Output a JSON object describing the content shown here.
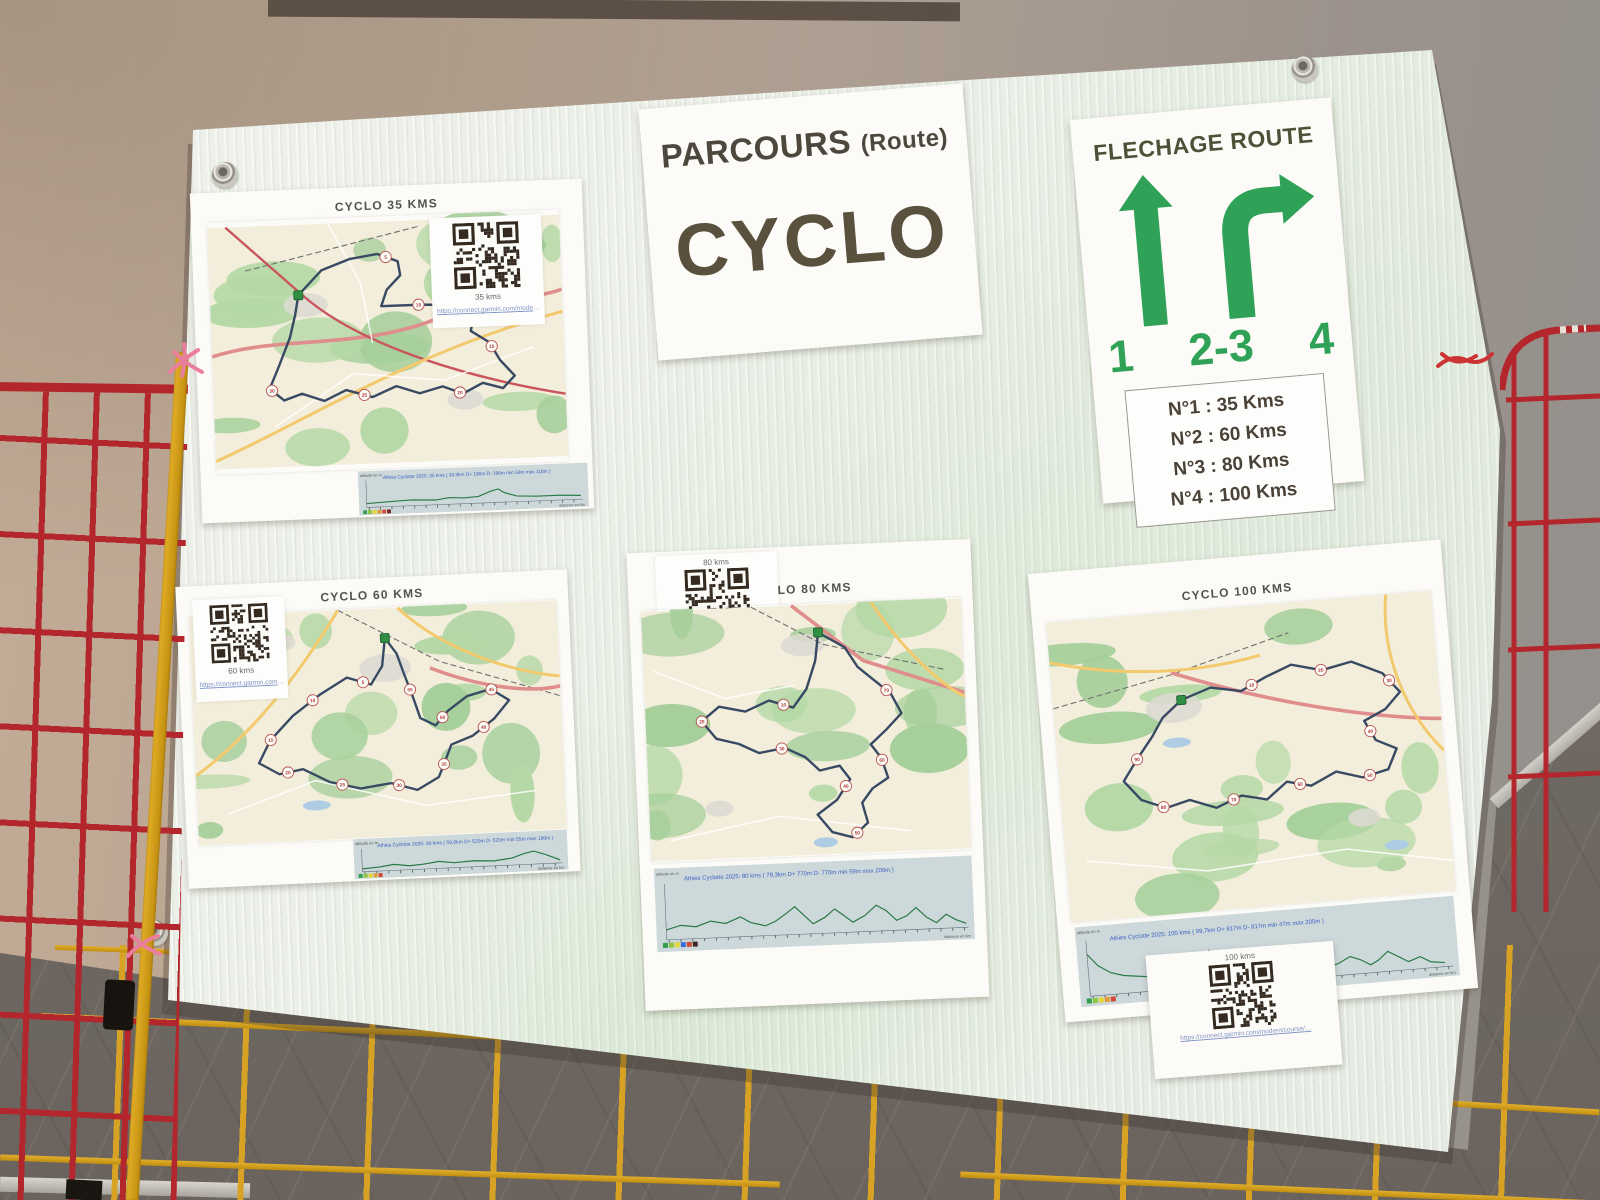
{
  "signs": {
    "parcours": {
      "title": "PARCOURS",
      "subtitle": "(Route)",
      "main": "CYCLO"
    },
    "flechage": {
      "title": "FLECHAGE ROUTE",
      "arrow_labels": [
        "1",
        "2-3",
        "4"
      ],
      "legend_lines": [
        "N°1 : 35 Kms",
        "N°2 : 60 Kms",
        "N°3 : 80 Kms",
        "N°4 : 100 Kms"
      ]
    }
  },
  "maps": [
    {
      "title": "CYCLO 35 KMS",
      "qr_caption": "35 kms",
      "qr_link": "https://connect.garmin.com/modern/course/…",
      "profile_annotation": "Athies Cyclotte 2025: 35 kms ( 34,9km  D+ 196m  D- 196m  min 59m  max 118m )",
      "profile_ylabel": "altitude en m",
      "profile_xlabel": "distance en km",
      "km_markers": [
        "5",
        "10",
        "15",
        "20",
        "25",
        "30"
      ]
    },
    {
      "title": "CYCLO 60 KMS",
      "qr_caption": "60 kms",
      "qr_link": "https://connect.garmin.com/modern/course/…",
      "profile_annotation": "Athies Cyclotte 2025: 60 kms ( 59,8km  D+ 520m  D- 520m  min 55m  max 190m )",
      "profile_ylabel": "altitude en m",
      "profile_xlabel": "distance en km",
      "km_markers": [
        "5",
        "10",
        "15",
        "20",
        "25",
        "30",
        "35",
        "40",
        "45",
        "50",
        "55"
      ]
    },
    {
      "title": "CYCLO 80 KMS",
      "qr_caption": "80 kms",
      "qr_link": "https://connect.garmin.com/modern/course/…",
      "profile_annotation": "Athies Cyclotte 2025: 80 kms ( 79,3km  D+ 770m  D- 770m  min 59m  max 200m )",
      "profile_ylabel": "altitude en m",
      "profile_xlabel": "distance en km",
      "km_markers": [
        "10",
        "20",
        "30",
        "40",
        "50",
        "60",
        "70"
      ]
    },
    {
      "title": "CYCLO 100 KMS",
      "qr_caption": "100 kms",
      "qr_link": "https://connect.garmin.com/modern/course/…",
      "profile_annotation": "Athies Cyclotte 2025: 100 kms ( 99,7km  D+ 817m  D- 817m  min 47m  max 205m )",
      "profile_ylabel": "altitude en m",
      "profile_xlabel": "distance en km",
      "km_markers": [
        "10",
        "20",
        "30",
        "40",
        "50",
        "60",
        "70",
        "80",
        "90"
      ]
    }
  ],
  "colors": {
    "arrow_green": "#2fa257",
    "fence_red": "#b2262c",
    "fence_yellow": "#d8a325",
    "route_blue": "#384a63",
    "board_white": "#edf0e9",
    "wall_tan": "#b7a492",
    "wall_gray": "#6f6862"
  }
}
